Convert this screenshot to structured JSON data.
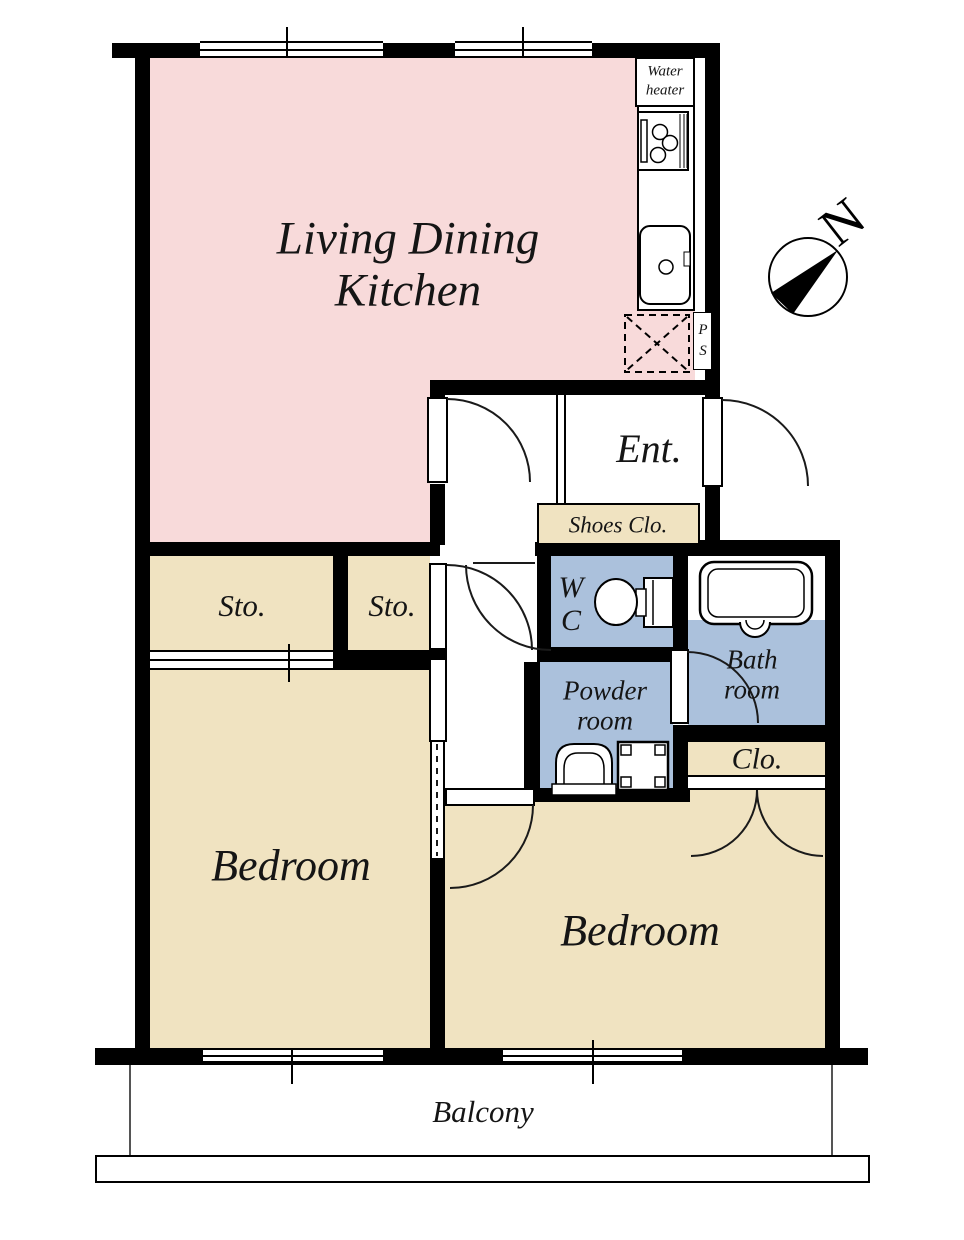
{
  "rooms": {
    "living_dining_kitchen": {
      "line1": "Living Dining",
      "line2": "Kitchen"
    },
    "entrance": {
      "label": "Ent."
    },
    "shoes_closet": {
      "label": "Shoes Clo."
    },
    "storage_1": {
      "label": "Sto."
    },
    "storage_2": {
      "label": "Sto."
    },
    "wc": {
      "line1": "W",
      "line2": "C"
    },
    "powder_room": {
      "line1": "Powder",
      "line2": "room"
    },
    "bathroom": {
      "line1": "Bath",
      "line2": "room"
    },
    "closet": {
      "label": "Clo."
    },
    "bedroom_left": {
      "label": "Bedroom"
    },
    "bedroom_right": {
      "label": "Bedroom"
    },
    "balcony": {
      "label": "Balcony"
    }
  },
  "fixtures": {
    "water_heater": {
      "line1": "Water",
      "line2": "heater"
    },
    "pipe_space": {
      "line1": "P",
      "line2": "S"
    }
  },
  "compass": {
    "north": "N"
  },
  "colors": {
    "ldk_pink": "#f8dada",
    "room_beige": "#f0e3c1",
    "wet_blue": "#abc1dc",
    "wall": "#000000",
    "background": "#ffffff"
  }
}
